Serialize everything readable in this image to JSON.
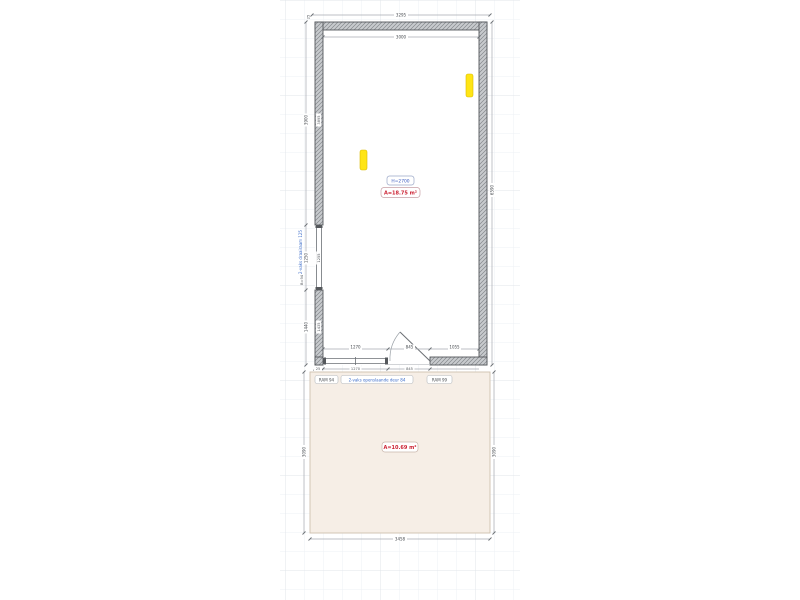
{
  "colors": {
    "grid_minor": "#eef1f4",
    "grid_major": "#e1e5ea",
    "wall_fill": "#c8cbce",
    "wall_hatch": "#84888c",
    "terrace_fill": "#f6eee6",
    "terrace_border": "#cfc0ae",
    "fixture_yellow": "#ffe515",
    "area_red": "#cc2233",
    "annotation_blue": "#3a6bc9"
  },
  "dims": {
    "wall_thickness": "25",
    "top_outer": "3295",
    "top_inner": "3000",
    "right_outer": "6590",
    "left_upper_outer": "3900",
    "left_upper_inner": "3895",
    "left_window_outer": "1250",
    "left_window_inner": "1255",
    "left_lower_outer": "1440",
    "left_lower_inner": "1435",
    "bottom_window": "1270",
    "bottom_door": "845",
    "bottom_wall_seg": "1055",
    "below_left": "25",
    "below_window": "1270",
    "below_door": "845",
    "terrace_width": "3458",
    "terrace_height_left": "3090",
    "terrace_height_right": "3090"
  },
  "labels": {
    "room_height": "H=2700",
    "room_area": "A=18.75 m²",
    "terrace_area": "A=10.69 m²",
    "window_left_name": "2-vaks draairaam 125",
    "window_left_code": "B=94",
    "comp1": "RAM 94",
    "comp2": "2-vaks openslaande deur 84",
    "comp3": "RAM 99"
  }
}
